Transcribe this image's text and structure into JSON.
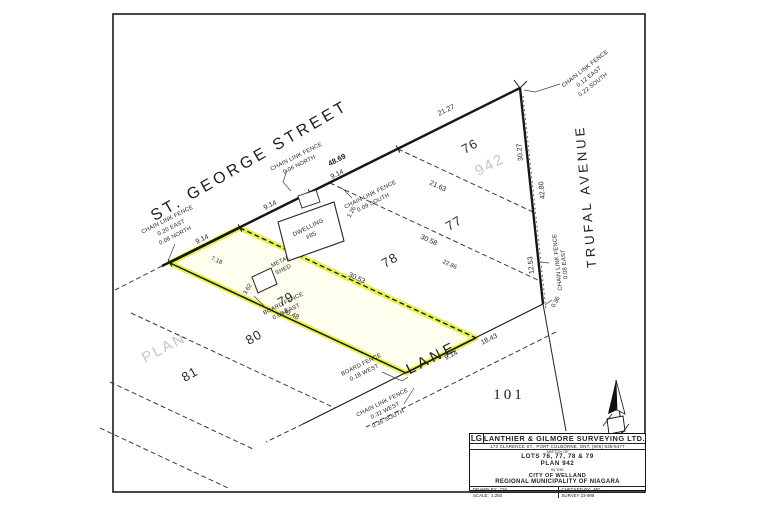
{
  "map": {
    "street_names": {
      "st_george": "ST. GEORGE STREET",
      "trufal": "TRUFAL AVENUE",
      "lane": "LANE"
    },
    "lot_numbers": {
      "l76": "76",
      "l77": "77",
      "l78": "78",
      "l79": "79",
      "l80": "80",
      "l81": "81",
      "l101": "101"
    },
    "watermark": {
      "word": "PLAN",
      "number": "942"
    },
    "dimensions": {
      "frontage_79": "9.14",
      "frontage_78": "9.14",
      "frontage_77": "9.14",
      "street_total": "48.69",
      "frontage_76": "21.27",
      "depth_76": "21.63",
      "depth_77": "30.58",
      "depth_77b": "22.86",
      "depth_78": "30.53",
      "depth_79": "30.48",
      "offset_79": "7.18",
      "trufal_upper": "30.27",
      "trufal_mid": "42.80",
      "trufal_lower": "12.53",
      "corner_tie": "0.36",
      "lane_west": "9.14",
      "lane_east": "18.43",
      "shed_tie": "3.62",
      "dwelling_tie": "1.26"
    },
    "buildings": {
      "dwelling_line1": "DWELLING",
      "dwelling_line2": "#85",
      "shed_line1": "METAL",
      "shed_line2": "SHED"
    },
    "fences": {
      "nw_corner_l1": "CHAIN LINK FENCE",
      "nw_corner_l2": "0.20 EAST",
      "nw_corner_l3": "0.08 NORTH",
      "street_north_l1": "CHAIN LINK FENCE",
      "street_north_l2": "0.06 NORTH",
      "street_south_l1": "CHAIN LINK FENCE",
      "street_south_l2": "0.09 SOUTH",
      "ne_corner_l1": "CHAIN LINK FENCE",
      "ne_corner_l2": "0.12 EAST",
      "ne_corner_l3": "0.22 SOUTH",
      "trufal_l1": "CHAIN LINK FENCE",
      "trufal_l2": "0.08 EAST",
      "board_79_l1": "BOARD FENCE",
      "board_79_l2": "0.08 EAST",
      "board_lane_l1": "BOARD FENCE",
      "board_lane_l2": "0.18 WEST",
      "lane_corner_l1": "CHAIN LINK FENCE",
      "lane_corner_l2": "0.32 WEST",
      "lane_corner_l3": "0.36 SOUTH"
    }
  },
  "title_block": {
    "logo": "LG",
    "company": "LANTHIER & GILMORE SURVEYING LTD.",
    "address": "173 CLARENCE ST.,  PORT COLBORNE, ONT. (905) 835-5477",
    "sketch_of": "SKETCH OF",
    "lots_line": "LOTS 76, 77, 78 & 79",
    "plan_line": "PLAN 942",
    "in_the": "IN THE",
    "city_line": "CITY OF WELLAND",
    "region_line": "REGIONAL MUNICIPALITY OF NIAGARA",
    "drawn_by_label": "DRAWN BY:",
    "drawn_by": "CM",
    "checked_by_label": "CHECKED BY:",
    "checked_by": "MG",
    "scale_label": "SCALE:",
    "scale": "1:250",
    "survey": "SURVEY 23-999"
  }
}
